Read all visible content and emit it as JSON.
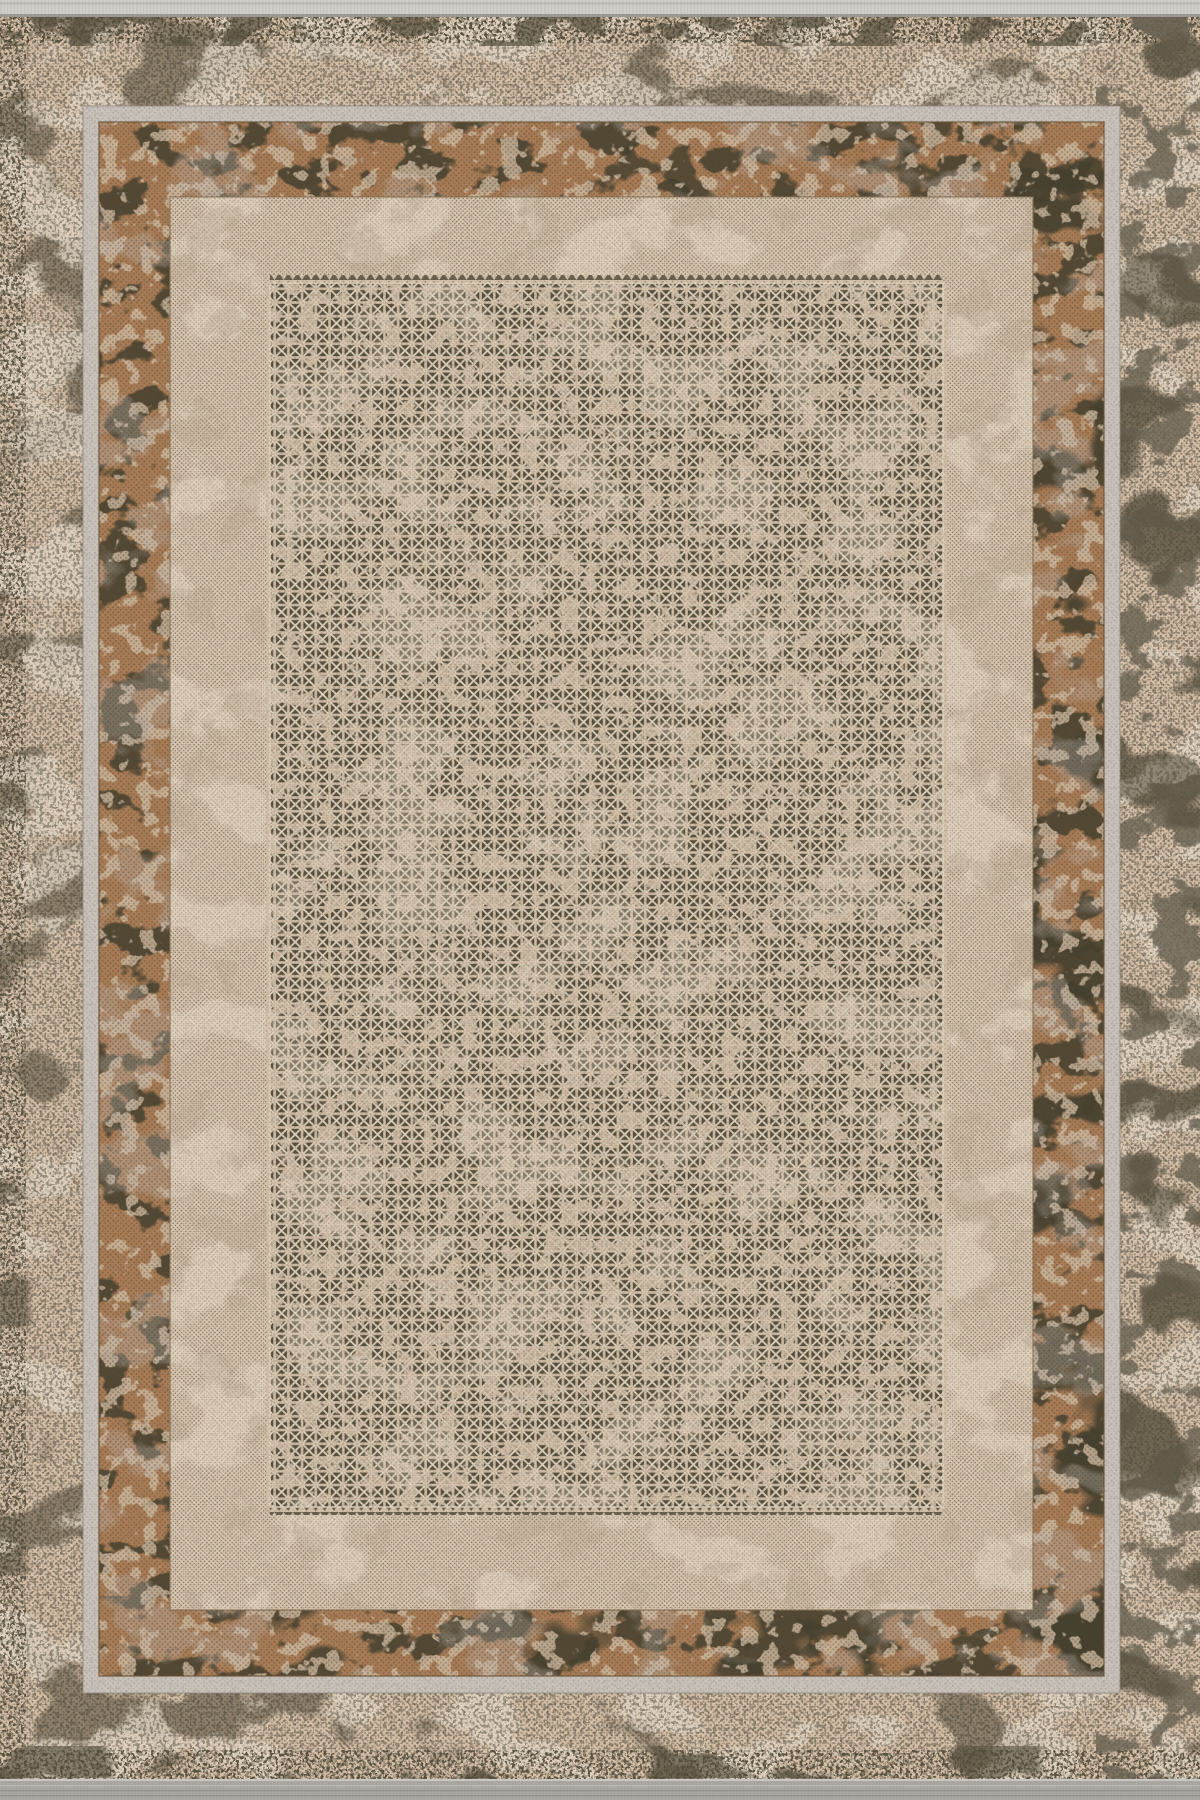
{
  "photo": {
    "alt": "Top-down product photo of a distressed vintage-style area rug in beige, tan, rust brown and charcoal. Layered rectangular borders: a mottled outer band, a light grey frame line, a rust-brown eroded inner border, a plain woven beige field, and a large central panel densely filled with a lattice of small dark squares each holding a light X motif. Short grey fringe bands run along the top and bottom edges.",
    "subject": "distressed bordered area rug",
    "motif": "boxed-x-lattice",
    "panel_grid": {
      "columns": 49,
      "rows": 89,
      "cell_px": 13.7
    }
  },
  "colors": {
    "outer_base": "#d6c0a7",
    "outer_dark": "#564f3e",
    "outer_wash": "#e4d7c5",
    "outer_gray": "#6f6759",
    "speckle": "#4b463a",
    "frame_light": "#c8c2ba",
    "frame_shadow": "#958d82",
    "rust": "#a97c55",
    "rust_dark": "#45402f",
    "rust_worn": "#d2bca2",
    "rust_gray": "#c4bab2",
    "rust_outline": "#6b5436",
    "field": "#dac7b1",
    "field_dot": "#6d604d",
    "field_wash": "#e6d9c6",
    "field_smudge": "#b7a58d",
    "field_line": "#8a7458",
    "panel_bg": "#d3c0a9",
    "panel_dark": "#574f3e",
    "panel_x": "#e0d2bb",
    "panel_worn": "#d8c5ae",
    "fringe_top": "#d3d0cc",
    "fringe_bottom": "#a7a49f",
    "fringe_stripe": "#b3afa9",
    "fringe_shadow": "#8f8a83",
    "fringe_hi": "#d7d4d0",
    "fringe_stitch_l": "#cac7c2",
    "fringe_stitch_d": "#807c76",
    "grain": "#3f3a2f"
  }
}
